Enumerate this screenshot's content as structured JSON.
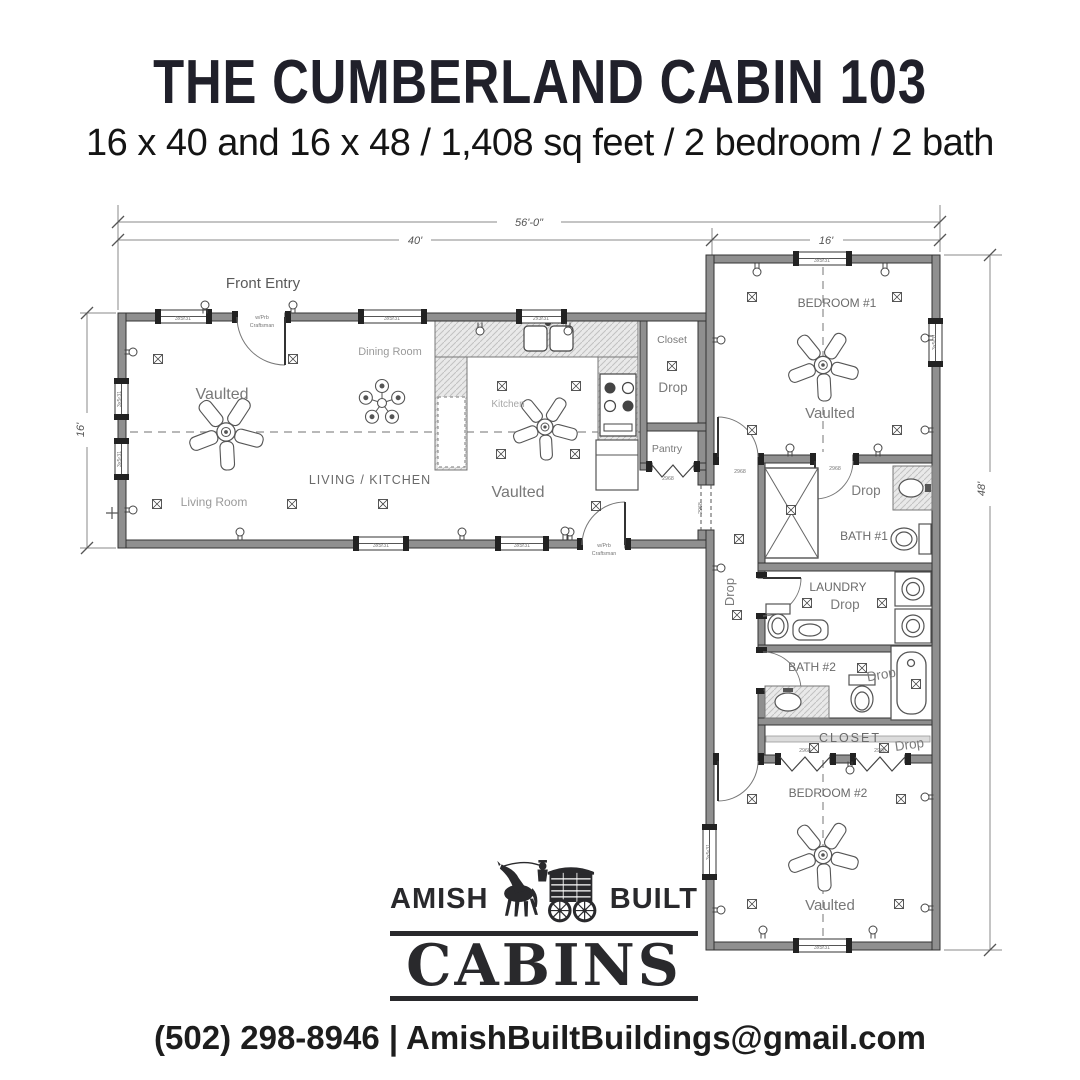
{
  "header": {
    "title": "THE CUMBERLAND CABIN 103",
    "subtitle": "16 x 40 and 16 x 48 / 1,408 sq feet / 2 bedroom / 2 bath"
  },
  "logo": {
    "left_word": "AMISH",
    "right_word": "BUILT",
    "main_word": "CABINS"
  },
  "footer": {
    "contact": "(502) 298-8946 | AmishBuiltBuildings@gmail.com"
  },
  "plan": {
    "colors": {
      "ink": "#20202a",
      "wall": "#8f8f8f",
      "line": "#3d3d3d",
      "label": "#6e6e6e",
      "faint": "#9a9a9a",
      "counter_hatch": "#e7e7e7"
    },
    "dim_labels": [
      {
        "t": "56'-0\"",
        "x": 529,
        "y": 226,
        "name": "dim-overall-width"
      },
      {
        "t": "40'",
        "x": 415,
        "y": 244,
        "name": "dim-left-wing-width"
      },
      {
        "t": "16'",
        "x": 826,
        "y": 244,
        "name": "dim-right-wing-width"
      },
      {
        "t": "16'",
        "x": 84,
        "y": 430,
        "rot": -90,
        "name": "dim-left-wing-depth"
      },
      {
        "t": "48'",
        "x": 985,
        "y": 489,
        "rot": -90,
        "name": "dim-right-wing-depth"
      }
    ],
    "room_labels": [
      {
        "t": "Front Entry",
        "x": 263,
        "y": 288,
        "fs": 15,
        "c": "#5a5a5a",
        "name": "label-front-entry"
      },
      {
        "t": "Dining Room",
        "x": 390,
        "y": 355,
        "fs": 11,
        "c": "#9a9a9a",
        "name": "label-dining-room"
      },
      {
        "t": "Vaulted",
        "x": 222,
        "y": 399,
        "fs": 16,
        "c": "#787878",
        "name": "label-vaulted-living"
      },
      {
        "t": "Kitchen",
        "x": 508,
        "y": 407,
        "fs": 10,
        "c": "#a8a8a8",
        "name": "label-kitchen"
      },
      {
        "t": "LIVING / KITCHEN",
        "x": 370,
        "y": 484,
        "fs": 12.5,
        "c": "#6a6a6a",
        "ls": 1,
        "name": "label-living-kitchen"
      },
      {
        "t": "Living Room",
        "x": 214,
        "y": 506,
        "fs": 12,
        "c": "#9a9a9a",
        "name": "label-living-room"
      },
      {
        "t": "Vaulted",
        "x": 518,
        "y": 497,
        "fs": 16,
        "c": "#787878",
        "name": "label-vaulted-kitchen"
      },
      {
        "t": "Closet",
        "x": 672,
        "y": 343,
        "fs": 10.5,
        "c": "#7a7a7a",
        "name": "label-closet-front"
      },
      {
        "t": "Drop",
        "x": 673,
        "y": 392,
        "fs": 13.5,
        "c": "#7a7a7a",
        "name": "label-drop-closet"
      },
      {
        "t": "Pantry",
        "x": 667,
        "y": 452,
        "fs": 10.5,
        "c": "#7a7a7a",
        "name": "label-pantry"
      },
      {
        "t": "BEDROOM #1",
        "x": 837,
        "y": 307,
        "fs": 12,
        "c": "#6a6a6a",
        "name": "label-bedroom-1"
      },
      {
        "t": "Vaulted",
        "x": 830,
        "y": 418,
        "fs": 15,
        "c": "#787878",
        "name": "label-vaulted-bedroom-1"
      },
      {
        "t": "Drop",
        "x": 866,
        "y": 495,
        "fs": 13.5,
        "c": "#7a7a7a",
        "name": "label-drop-bath-1"
      },
      {
        "t": "BATH #1",
        "x": 864,
        "y": 540,
        "fs": 12,
        "c": "#6a6a6a",
        "name": "label-bath-1"
      },
      {
        "t": "Drop",
        "x": 734,
        "y": 592,
        "fs": 13,
        "c": "#7a7a7a",
        "rot": -90,
        "name": "label-drop-hall"
      },
      {
        "t": "LAUNDRY",
        "x": 838,
        "y": 591,
        "fs": 12,
        "c": "#6a6a6a",
        "name": "label-laundry"
      },
      {
        "t": "Drop",
        "x": 845,
        "y": 609,
        "fs": 13.5,
        "c": "#7a7a7a",
        "name": "label-drop-laundry"
      },
      {
        "t": "BATH #2",
        "x": 812,
        "y": 671,
        "fs": 12,
        "c": "#6a6a6a",
        "name": "label-bath-2"
      },
      {
        "t": "Drop",
        "x": 882,
        "y": 679,
        "fs": 13.5,
        "c": "#7a7a7a",
        "rot": -10,
        "name": "label-drop-bath-2"
      },
      {
        "t": "CLOSET",
        "x": 850,
        "y": 742,
        "fs": 12.5,
        "c": "#6a6a6a",
        "ls": 2,
        "name": "label-closet-2"
      },
      {
        "t": "Drop",
        "x": 910,
        "y": 749,
        "fs": 13.5,
        "c": "#7a7a7a",
        "rot": -8,
        "name": "label-drop-closet-2"
      },
      {
        "t": "BEDROOM #2",
        "x": 828,
        "y": 797,
        "fs": 12,
        "c": "#6a6a6a",
        "name": "label-bedroom-2"
      },
      {
        "t": "Vaulted",
        "x": 830,
        "y": 910,
        "fs": 15,
        "c": "#787878",
        "name": "label-vaulted-bedroom-2"
      }
    ],
    "tiny_labels": [
      {
        "t": "3x5r31",
        "x": 183,
        "y": 320
      },
      {
        "t": "3x5r31",
        "x": 392,
        "y": 320
      },
      {
        "t": "2x3r31",
        "x": 541,
        "y": 320
      },
      {
        "t": "3x5r31",
        "x": 381,
        "y": 547
      },
      {
        "t": "3x5r31",
        "x": 522,
        "y": 547
      },
      {
        "t": "3x5r31",
        "x": 822,
        "y": 262
      },
      {
        "t": "3x5r31",
        "x": 822,
        "y": 949
      },
      {
        "t": "3x5r31",
        "x": 121,
        "y": 399,
        "rot": -90
      },
      {
        "t": "3x5r31",
        "x": 121,
        "y": 459,
        "rot": -90
      },
      {
        "t": "3x5r31",
        "x": 936,
        "y": 342,
        "rot": -90
      },
      {
        "t": "3x5r31",
        "x": 710,
        "y": 852,
        "rot": -90
      },
      {
        "t": "w/Prb",
        "x": 262,
        "y": 319
      },
      {
        "t": "Craftsman",
        "x": 262,
        "y": 327
      },
      {
        "t": "w/Prb",
        "x": 604,
        "y": 547
      },
      {
        "t": "Craftsman",
        "x": 604,
        "y": 555
      },
      {
        "t": "2968",
        "x": 740,
        "y": 473
      },
      {
        "t": "2968",
        "x": 668,
        "y": 480
      },
      {
        "t": "2968",
        "x": 805,
        "y": 752
      },
      {
        "t": "2968",
        "x": 880,
        "y": 752
      },
      {
        "t": "2968",
        "x": 702,
        "y": 508,
        "rot": -90
      },
      {
        "t": "2968",
        "x": 835,
        "y": 470
      }
    ],
    "windows": [
      {
        "x": 157,
        "y": 310,
        "w": 53,
        "h": 13,
        "o": "h"
      },
      {
        "x": 360,
        "y": 310,
        "w": 65,
        "h": 13,
        "o": "h"
      },
      {
        "x": 518,
        "y": 310,
        "w": 47,
        "h": 13,
        "o": "h"
      },
      {
        "x": 355,
        "y": 537,
        "w": 52,
        "h": 13,
        "o": "h"
      },
      {
        "x": 497,
        "y": 537,
        "w": 50,
        "h": 13,
        "o": "h"
      },
      {
        "x": 795,
        "y": 252,
        "w": 55,
        "h": 13,
        "o": "h"
      },
      {
        "x": 795,
        "y": 939,
        "w": 55,
        "h": 13,
        "o": "h"
      },
      {
        "x": 115,
        "y": 380,
        "w": 13,
        "h": 38,
        "o": "v"
      },
      {
        "x": 115,
        "y": 440,
        "w": 13,
        "h": 38,
        "o": "v"
      },
      {
        "x": 929,
        "y": 320,
        "w": 13,
        "h": 45,
        "o": "v"
      },
      {
        "x": 703,
        "y": 826,
        "w": 13,
        "h": 52,
        "o": "v"
      }
    ],
    "fans": [
      {
        "x": 226,
        "y": 432,
        "r": 38
      },
      {
        "x": 545,
        "y": 427,
        "r": 33
      },
      {
        "x": 823,
        "y": 365,
        "r": 36
      },
      {
        "x": 823,
        "y": 855,
        "r": 36
      }
    ],
    "chandelier": {
      "x": 382,
      "y": 403
    },
    "outlets": [
      [
        480,
        331,
        0
      ],
      [
        568,
        331,
        0
      ],
      [
        757,
        272,
        0
      ],
      [
        885,
        272,
        0
      ],
      [
        850,
        770,
        0
      ],
      [
        133,
        352,
        270
      ],
      [
        133,
        510,
        270
      ],
      [
        721,
        340,
        270
      ],
      [
        721,
        568,
        270
      ],
      [
        721,
        910,
        270
      ],
      [
        240,
        532,
        180
      ],
      [
        462,
        532,
        180
      ],
      [
        570,
        532,
        180
      ],
      [
        790,
        448,
        180
      ],
      [
        878,
        448,
        180
      ],
      [
        763,
        930,
        180
      ],
      [
        873,
        930,
        180
      ],
      [
        205,
        305,
        180
      ],
      [
        293,
        305,
        180
      ],
      [
        565,
        531,
        180
      ],
      [
        925,
        338,
        90
      ],
      [
        925,
        430,
        90
      ],
      [
        925,
        797,
        90
      ],
      [
        925,
        908,
        90
      ]
    ],
    "boxes": [
      [
        158,
        359
      ],
      [
        293,
        359
      ],
      [
        157,
        504
      ],
      [
        292,
        504
      ],
      [
        383,
        504
      ],
      [
        502,
        386
      ],
      [
        576,
        386
      ],
      [
        501,
        454
      ],
      [
        575,
        454
      ],
      [
        672,
        366
      ],
      [
        596,
        506
      ],
      [
        752,
        297
      ],
      [
        897,
        297
      ],
      [
        752,
        430
      ],
      [
        897,
        430
      ],
      [
        791,
        510
      ],
      [
        739,
        539
      ],
      [
        737,
        615
      ],
      [
        807,
        603
      ],
      [
        882,
        603
      ],
      [
        862,
        668
      ],
      [
        916,
        684
      ],
      [
        814,
        748
      ],
      [
        884,
        748
      ],
      [
        752,
        799
      ],
      [
        901,
        799
      ],
      [
        752,
        904
      ],
      [
        899,
        904
      ]
    ]
  }
}
